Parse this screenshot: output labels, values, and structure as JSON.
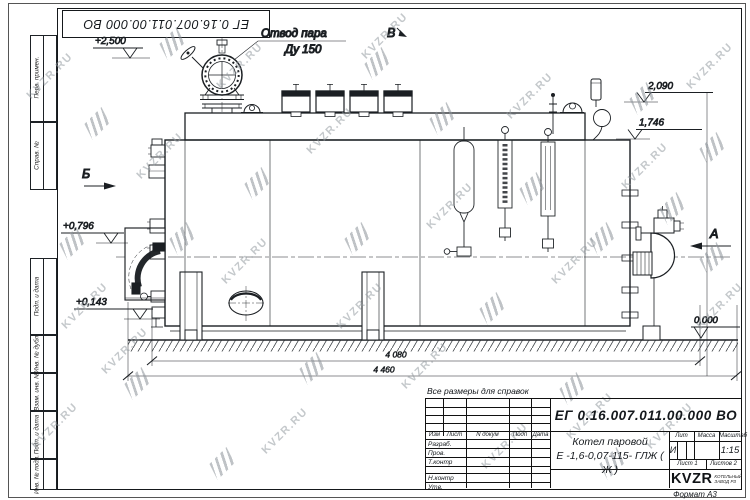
{
  "watermark": {
    "text": "KVZR.RU"
  },
  "frame": {
    "top_stamp": "ЕГ 0.16.007.011.00.000  ВО",
    "format_label": "Формат А3",
    "left_boxes": [
      "Перв. примен.",
      "Справ. №",
      "Подп. и дата",
      "Инв. № дубл.",
      "Взам. инв. №",
      "Подп. и дата",
      "Инв. № подл."
    ]
  },
  "note": "Все размеры для справок",
  "drawing": {
    "callout": {
      "line1": "Отвод пара",
      "line2": "Ду 150"
    },
    "views": {
      "b": "Б",
      "v": "В",
      "a": "А"
    },
    "levels": {
      "top": "+2,500",
      "upper": "2,090",
      "mid": "1,746",
      "front": "+0,796",
      "low": "+0,143",
      "zero": "0,000"
    },
    "dims": {
      "inner": "4 080",
      "overall": "4 460"
    }
  },
  "titleblock": {
    "designation": "ЕГ 0.16.007.011.00.000  ВО",
    "product": {
      "line1": "Котел паровой",
      "line2": "Е -1,6-0,07-115- ГЛЖ ( Ж )"
    },
    "cols": {
      "izm": "Изм",
      "list": "Лист",
      "ndok": "N докум",
      "podp": "Подп",
      "data": "Дата"
    },
    "rows": {
      "r1": "Разраб.",
      "r2": "Пров.",
      "r3": "Т.контр",
      "r4": "Н.контр",
      "r5": "Утв."
    },
    "lit": {
      "label": "Лит",
      "value": "И"
    },
    "mass": {
      "label": "Масса"
    },
    "scale": {
      "label": "Масштаб",
      "value": "1:15"
    },
    "sheet": "Лист 1",
    "sheets": "Листов 2",
    "logo": {
      "text": "KVZR",
      "sub1": "КОТЕЛЬНЫЙ",
      "sub2": "ЗАВОД РЗ"
    }
  }
}
